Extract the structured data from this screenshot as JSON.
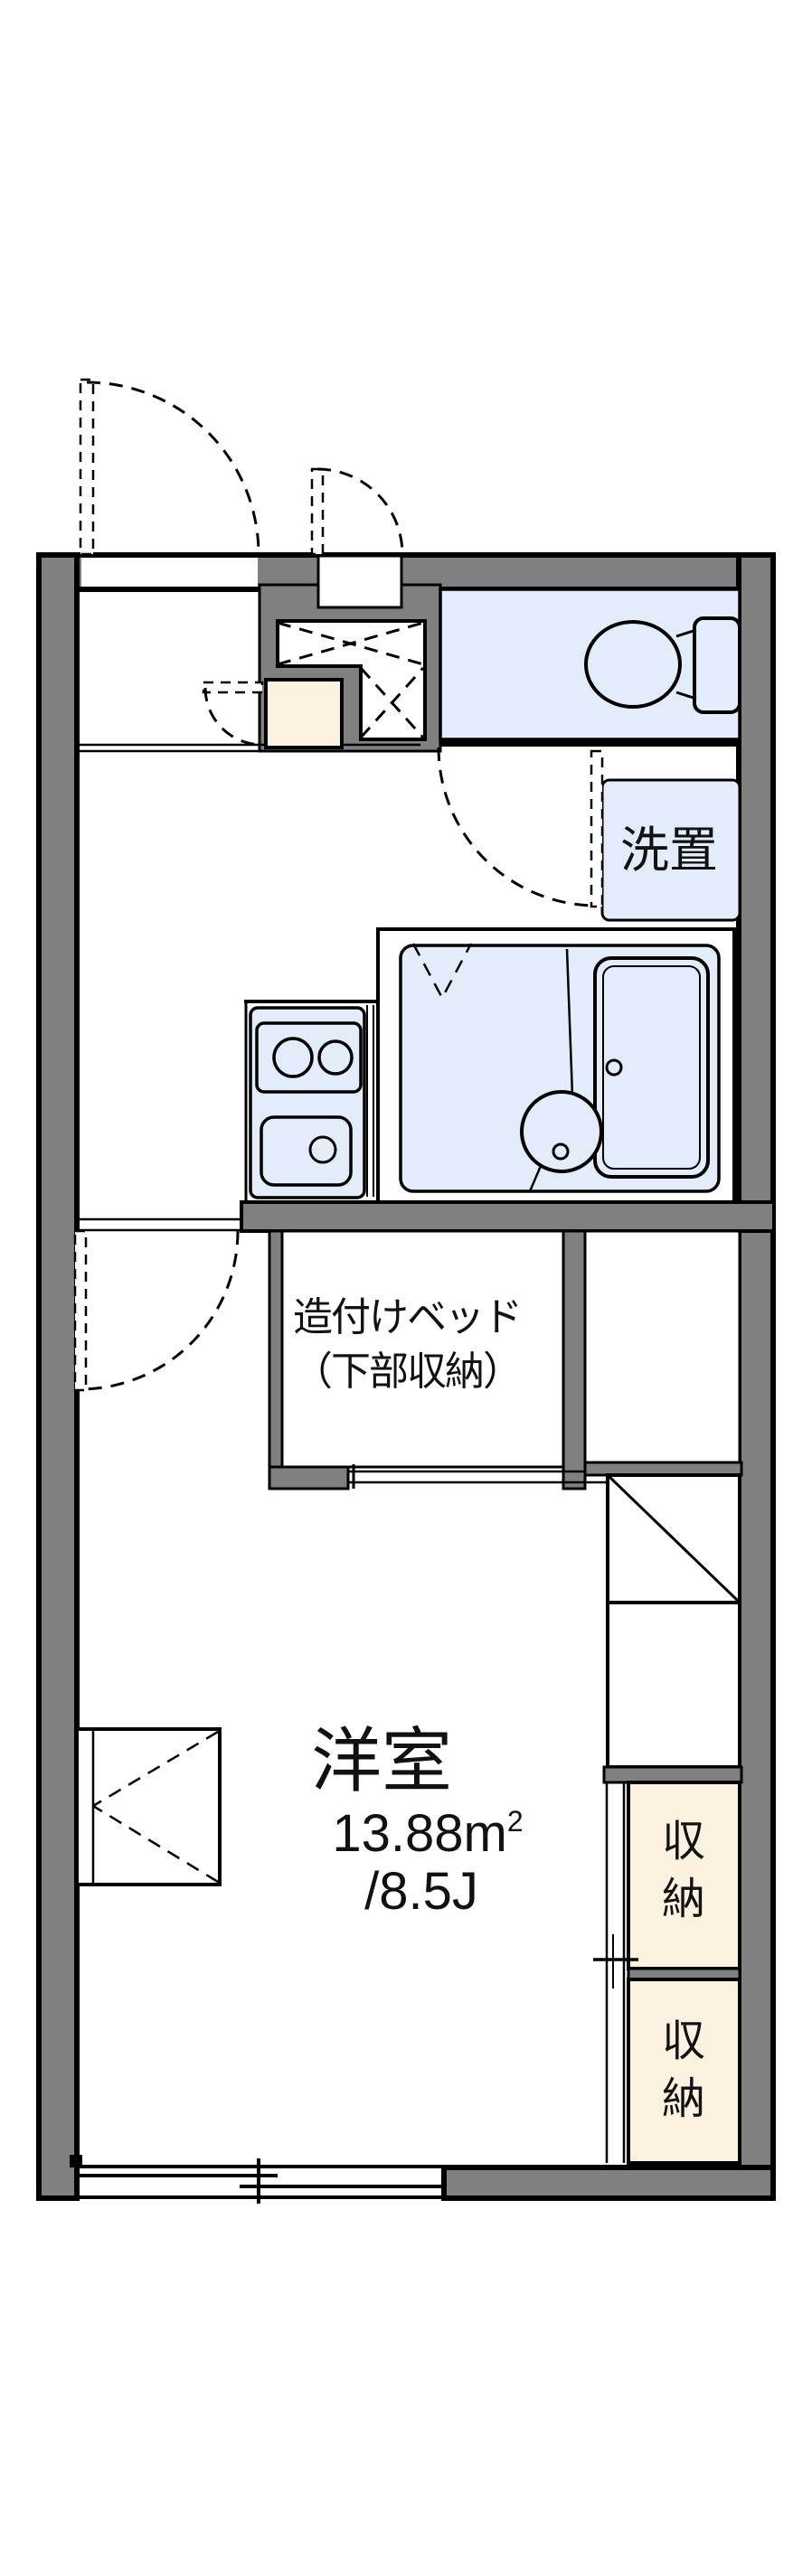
{
  "plan_title": "1K apartment floor plan",
  "colors": {
    "wall_gray": "#808080",
    "water_area_blue": "#E3ECFA",
    "storage_cream": "#FDF2E0",
    "line_black": "#111111"
  },
  "rooms": {
    "main_room": {
      "name": "洋室",
      "area": "13.88m",
      "area_sup": "2",
      "tatami": "/8.5J"
    },
    "built_in_bed": {
      "line1": "造付けベッド",
      "line2": "（下部収納）"
    },
    "washer_space": {
      "label": "洗置"
    },
    "closet_upper": {
      "char1": "収",
      "char2": "納"
    },
    "closet_lower": {
      "char1": "収",
      "char2": "納"
    }
  }
}
